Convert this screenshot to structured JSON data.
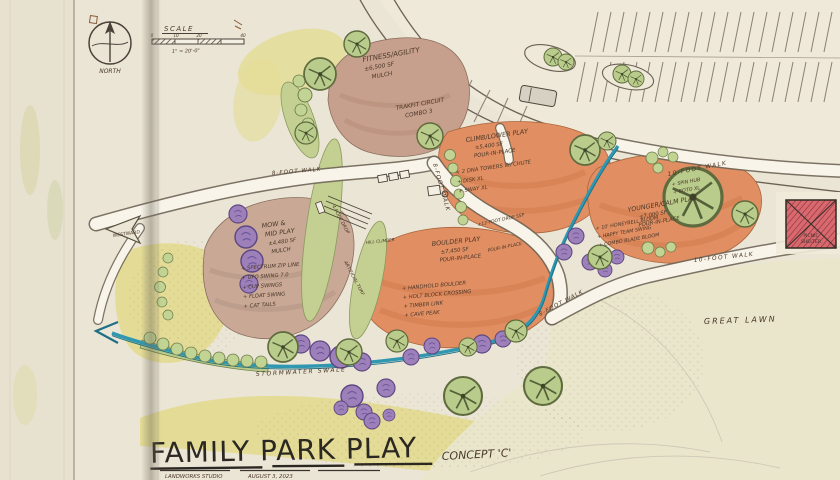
{
  "compass": {
    "north": "NORTH"
  },
  "scalebar": {
    "label": "SCALE",
    "ticks": [
      "0",
      "10",
      "20",
      "40"
    ],
    "note": "1\" = 20'-0\""
  },
  "areas": {
    "fitness": {
      "header": [
        "FITNESS/AGILITY",
        "±6,500 SF",
        "MULCH"
      ],
      "items": [
        "TRAKFIT CIRCUIT",
        "COMBO 3"
      ]
    },
    "climb": {
      "header": [
        "CLIMB/LOWER PLAY",
        "±5,400 SF",
        "POUR-IN-PLACE"
      ],
      "items": [
        "+ 2 DNA TOWERS W/ CHUTE",
        "+ DISK XL",
        "+ SWAY XL"
      ]
    },
    "younger": {
      "header": [
        "YOUNGER/CALM PLAY",
        "±7,000 SF",
        "POUR-IN-PLACE"
      ],
      "items_top": [
        "+ SPIN HUB",
        "+ ROTO XL"
      ],
      "items": [
        "+ 10' HONEYBELL BLOOM",
        "+ HAPPY TEAM SWING",
        "+ COMBO BLADE BLOOM"
      ]
    },
    "boulder": {
      "header": [
        "BOULDER PLAY",
        "±7,450 SF",
        "POUR-IN-PLACE"
      ],
      "items": [
        "+ HANDHOLD BOULDER",
        "+ HOLT BLOCK CROSSING",
        "+ TIMBER LINK",
        "+ CAVE PEAK"
      ]
    },
    "mow": {
      "header": [
        "MOW &",
        "MID PLAY",
        "±4,480 SF",
        "MULCH"
      ],
      "items": [
        "+ SPECTRUM ZIP LINE",
        "+ UFO SWING 7.0",
        "+ CUP SWINGS",
        "+ FLOAT SWING",
        "+ CAT TAILS"
      ]
    }
  },
  "labels": {
    "walk8": "8-FOOT WALK",
    "walk10": "10-FOOT WALK",
    "drop12": "±12-FOOT DROP SSP",
    "pour_in_place": "POUR-IN-PLACE",
    "drop4": "4-FOOT DROP",
    "turf": "ARTIFICIAL TURF",
    "hill_climber": "HILL CLIMBER",
    "swale": "STORMWATER SWALE",
    "great_lawn": "GREAT LAWN",
    "westward": "WESTWARD",
    "picnic_shelter_1": "PICNIC",
    "picnic_shelter_2": "SHELTER"
  },
  "title_block": {
    "title": "FAMILY PARK PLAY",
    "concept": "CONCEPT 'C'",
    "studio": "LANDWORKS STUDIO",
    "date": "AUGUST 3, 2023"
  },
  "palette": {
    "play_surface": "#e08e62",
    "mulch_area": "#c7a08d",
    "turf_green": "#c2d494",
    "tree_green": "#b9cc8b",
    "shrub_purple": "#9d80ba",
    "swale_teal": "#2f97b0",
    "shelter_red": "#d8696e",
    "paper": "#ebe5d6"
  }
}
